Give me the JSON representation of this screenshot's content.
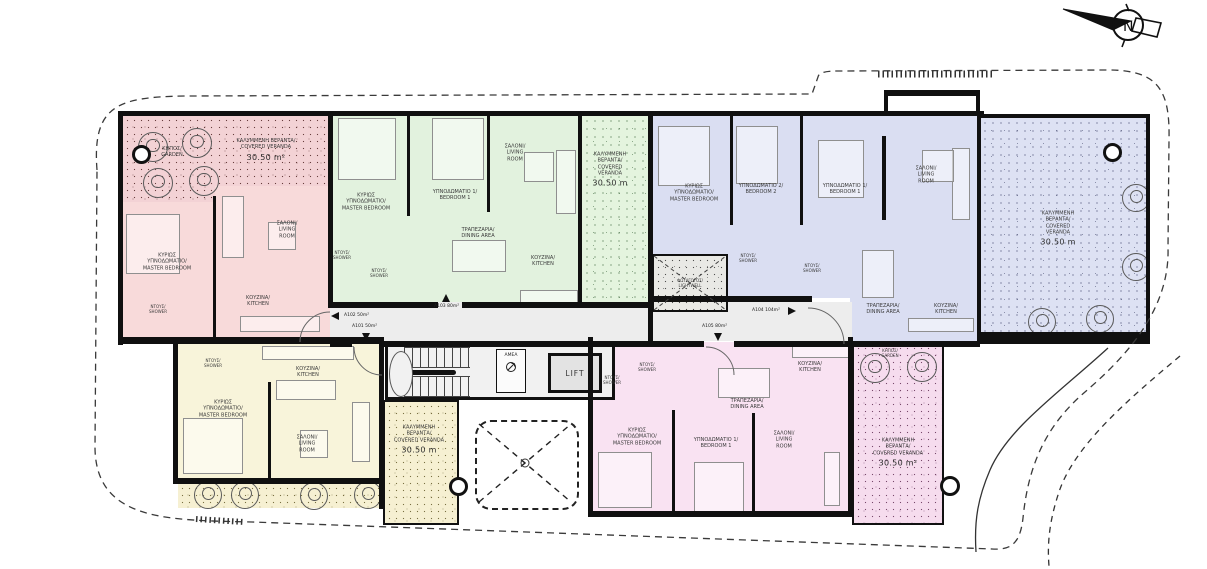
{
  "compass": {
    "label": "N"
  },
  "corridor": {
    "lift": "LIFT",
    "accessible_wc": "ΑΜΕΑ",
    "entrances": [
      {
        "label": "A102 50m²"
      },
      {
        "label": "A101 50m²"
      },
      {
        "label": "A103 80m²"
      },
      {
        "label": "A105 80m²"
      },
      {
        "label": "A104 104m²"
      }
    ]
  },
  "apartments": [
    {
      "unit": "A102",
      "garden": {
        "gr": "ΚΗΠΟΣ/",
        "en": "GARDEN"
      },
      "veranda": {
        "gr": "ΚΑΛΥΜΜΕΝΗ ΒΕΡΑΝΤΑ/",
        "en": "COVERED VERANDA",
        "area": "30.50 m²"
      },
      "rooms": {
        "master": {
          "gr": "ΚΥΡΙΩΣ ΥΠΝΟΔΩΜΑΤΙΟ/",
          "en": "MASTER BEDROOM"
        },
        "living": {
          "gr": "ΣΑΛΟΝΙ/",
          "en": "LIVING ROOM"
        },
        "kitchen": {
          "gr": "ΚΟΥΖΙΝΑ/",
          "en": "KITCHEN"
        },
        "shower": {
          "gr": "ΝΤΟΥΣ/",
          "en": "SHOWER"
        }
      }
    },
    {
      "unit": "A103",
      "veranda": {
        "gr": "ΚΑΛΥΜΜΕΝΗ ΒΕΡΑΝΤΑ/",
        "en": "COVERED VERANDA",
        "area": "30.50 m"
      },
      "rooms": {
        "master": {
          "gr": "ΚΥΡΙΩΣ ΥΠΝΟΔΩΜΑΤΙΟ/",
          "en": "MASTER BEDROOM"
        },
        "bedroom1": {
          "gr": "ΥΠΝΟΔΩΜΑΤΙΟ 1/",
          "en": "BEDROOM 1"
        },
        "living": {
          "gr": "ΣΑΛΟΝΙ/",
          "en": "LIVING ROOM"
        },
        "dining": {
          "gr": "ΤΡΑΠΕΖΑΡΙΑ/",
          "en": "DINING AREA"
        },
        "kitchen": {
          "gr": "ΚΟΥΖΙΝΑ/",
          "en": "KITCHEN"
        },
        "shower1": {
          "gr": "ΝΤΟΥΣ/",
          "en": "SHOWER"
        },
        "shower2": {
          "gr": "ΝΤΟΥΣ/",
          "en": "SHOWER"
        }
      }
    },
    {
      "unit": "A104",
      "veranda": {
        "gr": "ΚΑΛΥΜΜΕΝΗ ΒΕΡΑΝΤΑ/",
        "en": "COVERED VERANDA",
        "area": "30.50 m"
      },
      "lightwell": {
        "gr": "ΦΩΤΑΓΩΓΟΣ/",
        "en": "LIGHTWELL"
      },
      "rooms": {
        "master": {
          "gr": "ΚΥΡΙΩΣ ΥΠΝΟΔΩΜΑΤΙΟ/",
          "en": "MASTER BEDROOM"
        },
        "bedroom2": {
          "gr": "ΥΠΝΟΔΩΜΑΤΙΟ 2/",
          "en": "BEDROOM 2"
        },
        "bedroom1": {
          "gr": "ΥΠΝΟΔΩΜΑΤΙΟ 1/",
          "en": "BEDROOM 1"
        },
        "living": {
          "gr": "ΣΑΛΟΝΙ/",
          "en": "LIVING ROOM"
        },
        "dining": {
          "gr": "ΤΡΑΠΕΖΑΡΙΑ/",
          "en": "DINING AREA"
        },
        "kitchen": {
          "gr": "ΚΟΥΖΙΝΑ/",
          "en": "KITCHEN"
        },
        "shower1": {
          "gr": "ΝΤΟΥΣ/",
          "en": "SHOWER"
        },
        "shower2": {
          "gr": "ΝΤΟΥΣ/",
          "en": "SHOWER"
        }
      }
    },
    {
      "unit": "A101",
      "veranda": {
        "gr": "ΚΑΛΥΜΜΕΝΗ ΒΕΡΑΝΤΑ/",
        "en": "COVERED VERANDA",
        "area": "30.50 m"
      },
      "rooms": {
        "master": {
          "gr": "ΚΥΡΙΩΣ ΥΠΝΟΔΩΜΑΤΙΟ/",
          "en": "MASTER BEDROOM"
        },
        "living": {
          "gr": "ΣΑΛΟΝΙ/",
          "en": "LIVING ROOM"
        },
        "kitchen": {
          "gr": "ΚΟΥΖΙΝΑ/",
          "en": "KITCHEN"
        },
        "shower": {
          "gr": "ΝΤΟΥΣ/",
          "en": "SHOWER"
        }
      }
    },
    {
      "unit": "A105",
      "garden": {
        "gr": "ΚΗΠΟΣ/",
        "en": "GARDEN"
      },
      "veranda": {
        "gr": "ΚΑΛΥΜΜΕΝΗ ΒΕΡΑΝΤΑ/",
        "en": "COVERED VERANDA",
        "area": "30.50 m²"
      },
      "rooms": {
        "master": {
          "gr": "ΚΥΡΙΩΣ ΥΠΝΟΔΩΜΑΤΙΟ/",
          "en": "MASTER BEDROOM"
        },
        "bedroom1": {
          "gr": "ΥΠΝΟΔΩΜΑΤΙΟ 1/",
          "en": "BEDROOM 1"
        },
        "living": {
          "gr": "ΣΑΛΟΝΙ/",
          "en": "LIVING ROOM"
        },
        "dining": {
          "gr": "ΤΡΑΠΕΖΑΡΙΑ/",
          "en": "DINING AREA"
        },
        "kitchen": {
          "gr": "ΚΟΥΖΙΝΑ/",
          "en": "KITCHEN"
        },
        "shower1": {
          "gr": "ΝΤΟΥΣ/",
          "en": "SHOWER"
        },
        "shower2": {
          "gr": "ΝΤΟΥΣ/",
          "en": "SHOWER"
        }
      }
    }
  ]
}
